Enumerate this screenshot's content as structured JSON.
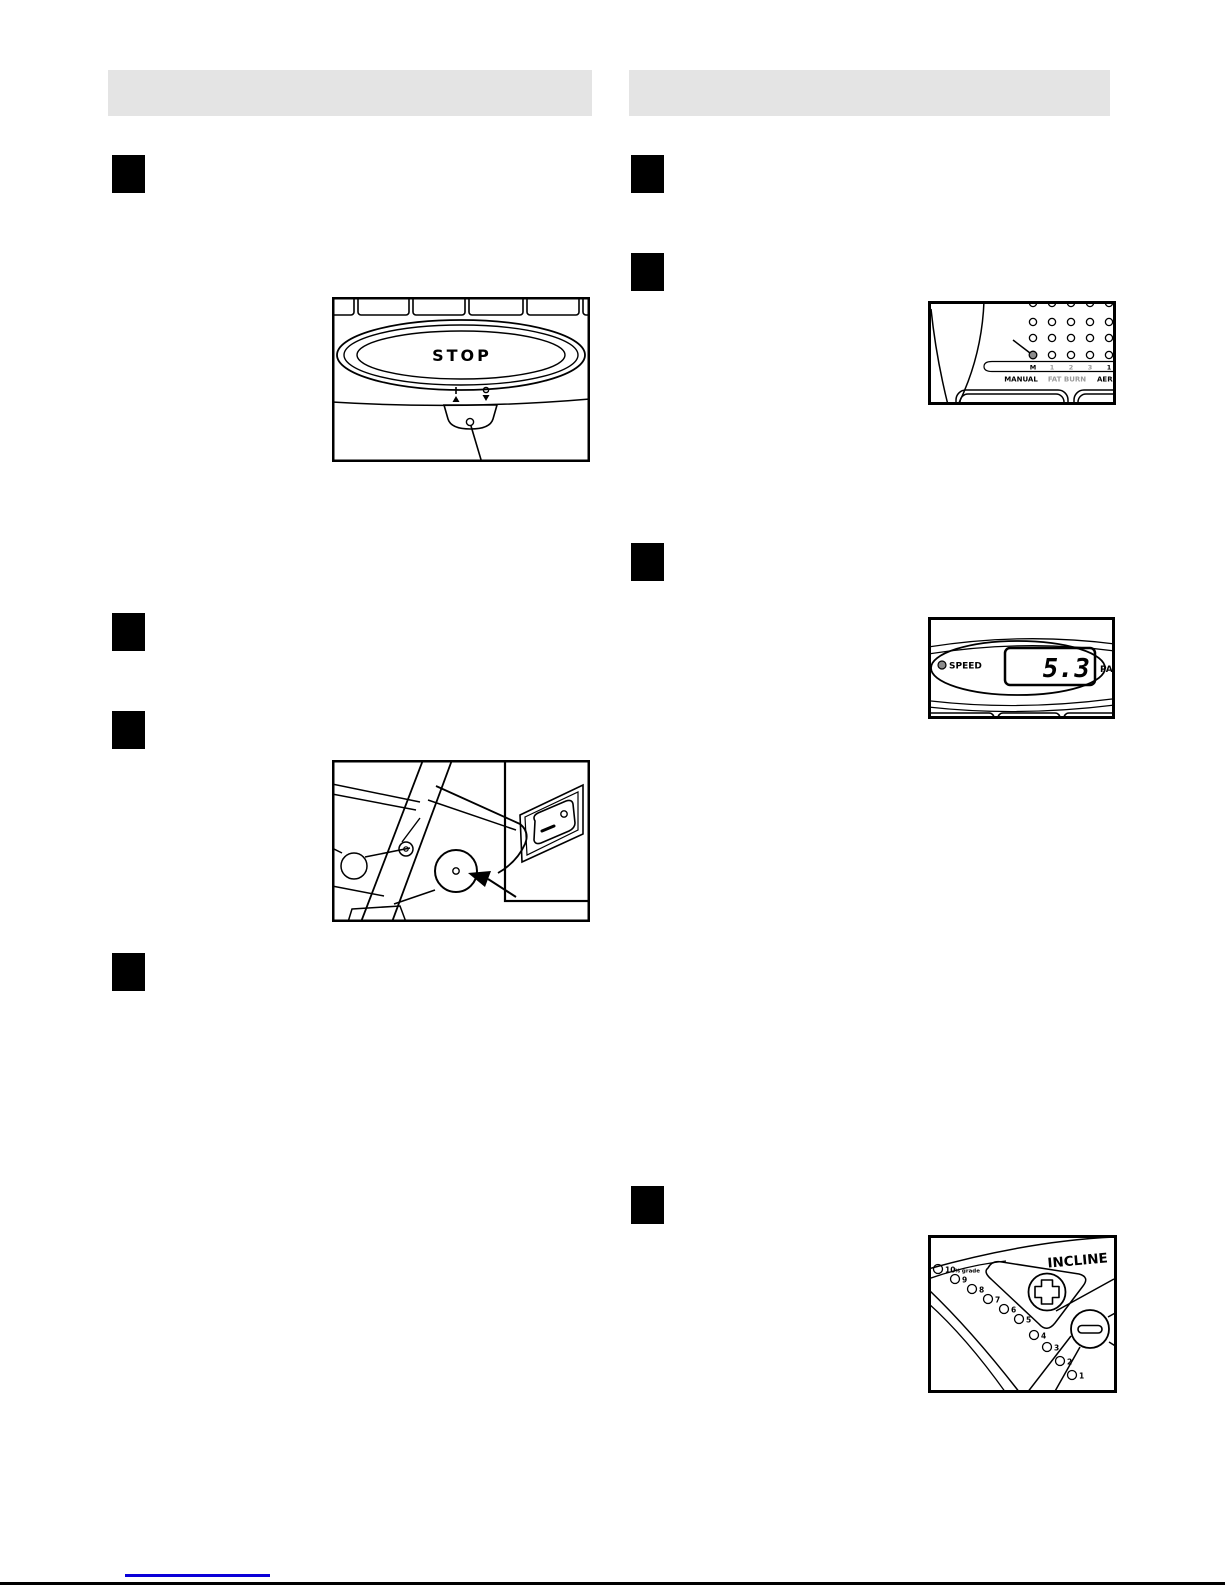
{
  "page": {
    "background": "#ffffff",
    "header_bar_color": "#e4e4e4",
    "step_marker_color": "#000000",
    "link_color": "#0a00d8",
    "footer_rule_color": "#000000"
  },
  "headers": {
    "left_title": "",
    "right_title": ""
  },
  "figures": {
    "stop_console": {
      "stop_button_label": "STOP"
    },
    "program_display": {
      "column_labels": [
        "M",
        "1",
        "2",
        "3",
        "1"
      ],
      "program_names": [
        "MANUAL",
        "FAT BURN",
        "AER"
      ],
      "muted_color": "#9a9a9a",
      "selected_dot_color": "#8c8c8c"
    },
    "speed_display": {
      "indicator_label": "SPEED",
      "value": "5.3",
      "pace_label": "PA",
      "led_color": "#8c8c8c"
    },
    "incline_control": {
      "title": "INCLINE",
      "lit_color": "#8c8c8c",
      "leds": [
        {
          "label": "10",
          "suffix": "% grade",
          "lit": false
        },
        {
          "label": "9",
          "suffix": "",
          "lit": false
        },
        {
          "label": "8",
          "suffix": "",
          "lit": false
        },
        {
          "label": "7",
          "suffix": "",
          "lit": false
        },
        {
          "label": "6",
          "suffix": "",
          "lit": false
        },
        {
          "label": "5",
          "suffix": "",
          "lit": false
        },
        {
          "label": "4",
          "suffix": "",
          "lit": false
        },
        {
          "label": "3",
          "suffix": "",
          "lit": true
        },
        {
          "label": "2",
          "suffix": "",
          "lit": true
        },
        {
          "label": "1",
          "suffix": "",
          "lit": true
        }
      ]
    }
  }
}
